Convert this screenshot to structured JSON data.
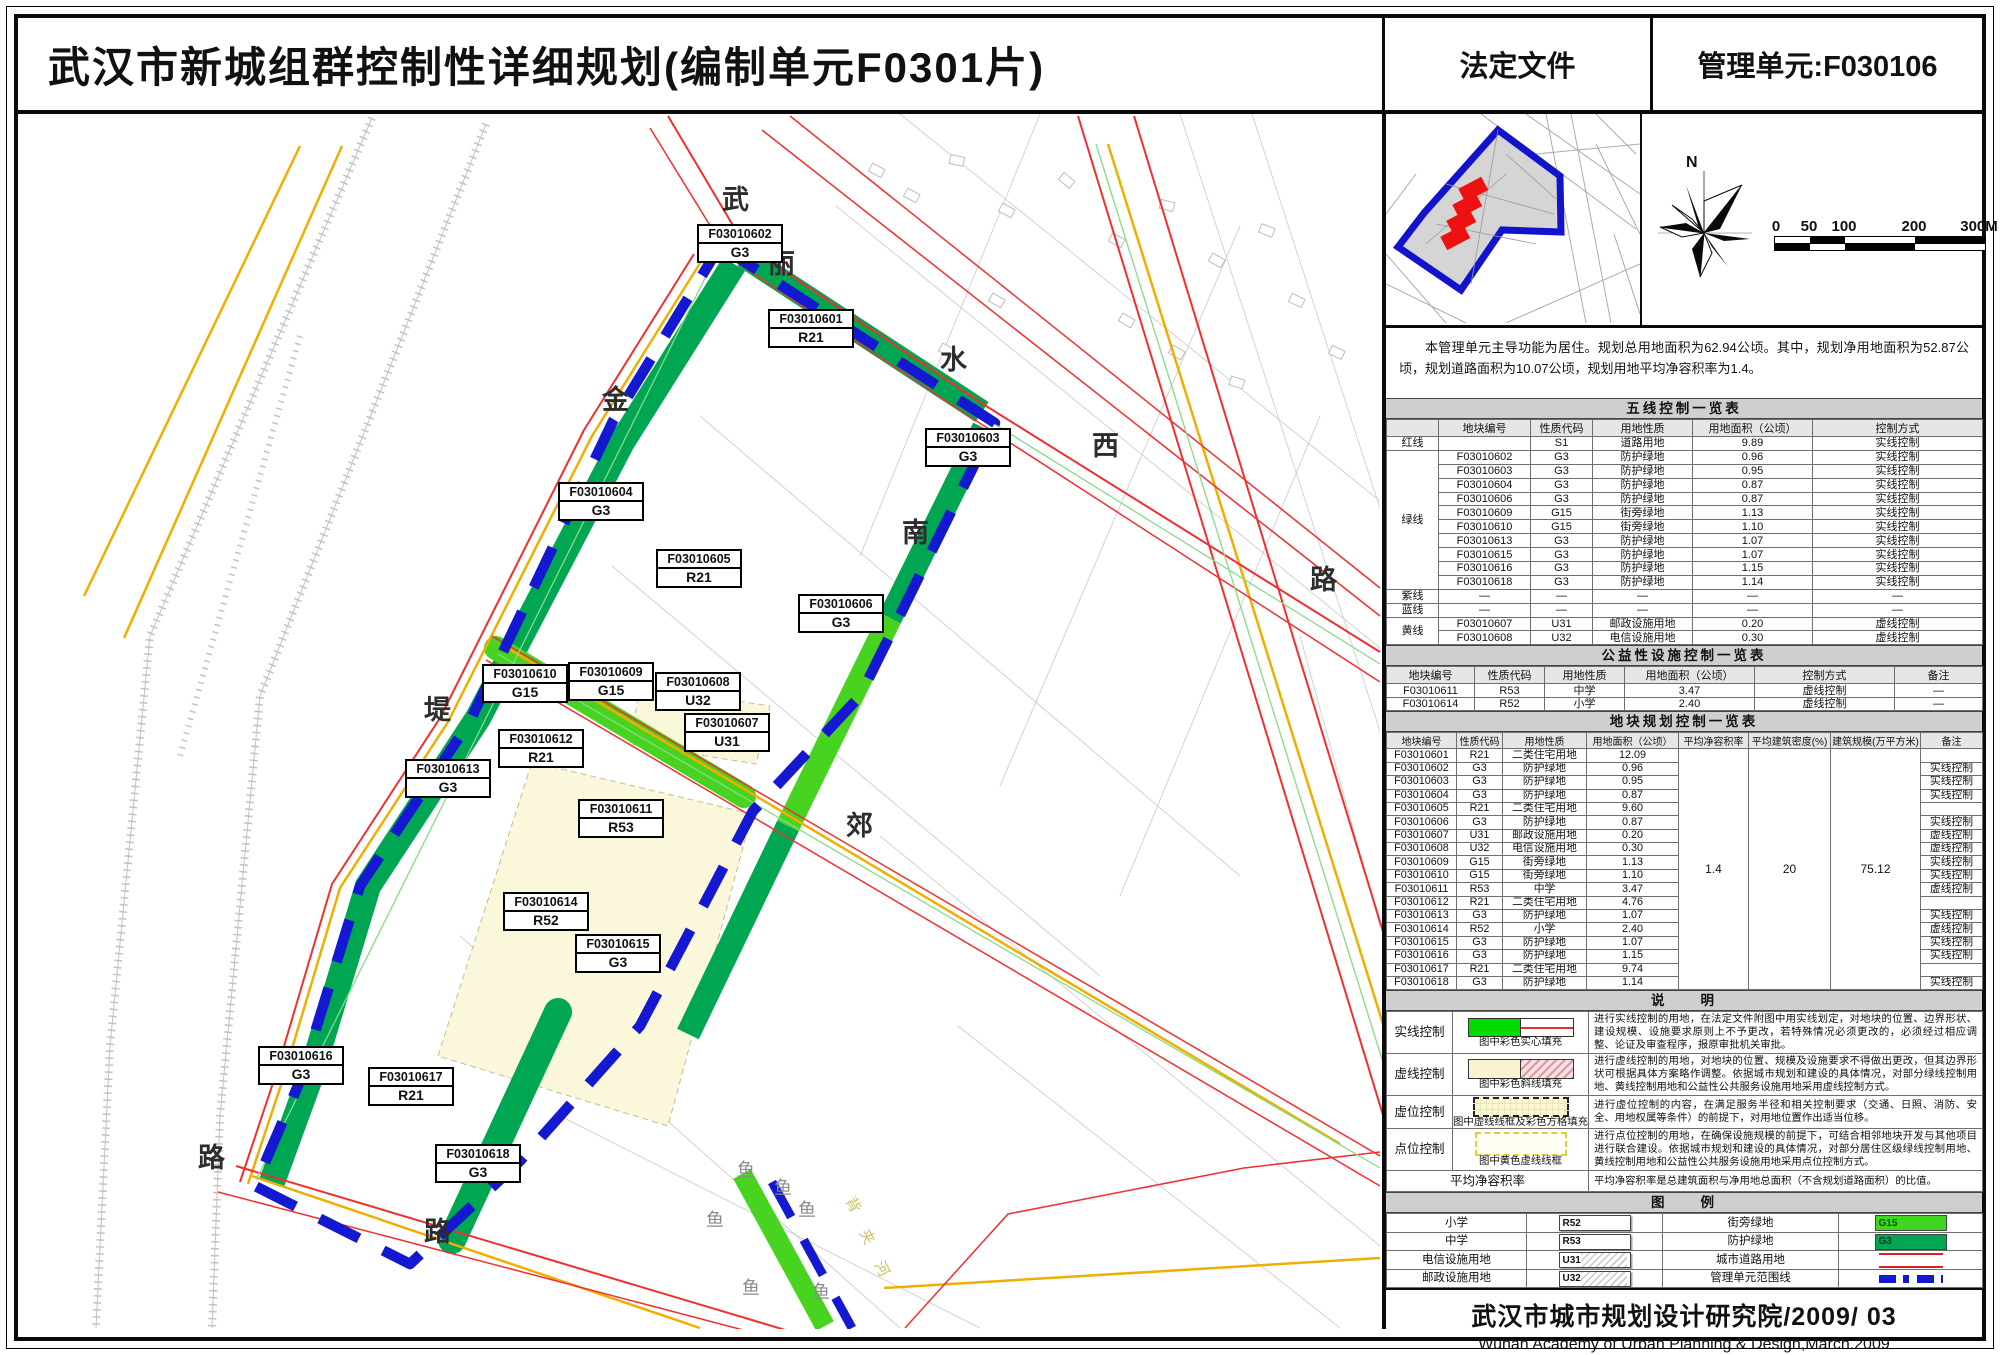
{
  "header": {
    "title": "武汉市新城组群控制性详细规划(编制单元F0301片)",
    "doc_type": "法定文件",
    "unit": "管理单元:F030106"
  },
  "compass": {
    "north": "N"
  },
  "scalebar": {
    "ticks": [
      "0",
      "50",
      "100",
      "200",
      "300M"
    ]
  },
  "intro": {
    "text": "本管理单元主导功能为居住。规划总用地面积为62.94公顷。其中，规划净用地面积为52.87公顷，规划道路面积为10.07公顷，规划用地平均净容积率为1.4。"
  },
  "five": {
    "title": "五线控制一览表",
    "headers": [
      "",
      "地块编号",
      "性质代码",
      "用地性质",
      "用地面积（公顷）",
      "控制方式"
    ],
    "rows": [
      {
        "cat": "红线",
        "span": 1,
        "code": "",
        "tcode": "S1",
        "use": "道路用地",
        "area": "9.89",
        "ctl": "实线控制"
      },
      {
        "cat": "绿线",
        "span": 10,
        "code": "F03010602",
        "tcode": "G3",
        "use": "防护绿地",
        "area": "0.96",
        "ctl": "实线控制"
      },
      {
        "code": "F03010603",
        "tcode": "G3",
        "use": "防护绿地",
        "area": "0.95",
        "ctl": "实线控制"
      },
      {
        "code": "F03010604",
        "tcode": "G3",
        "use": "防护绿地",
        "area": "0.87",
        "ctl": "实线控制"
      },
      {
        "code": "F03010606",
        "tcode": "G3",
        "use": "防护绿地",
        "area": "0.87",
        "ctl": "实线控制"
      },
      {
        "code": "F03010609",
        "tcode": "G15",
        "use": "街旁绿地",
        "area": "1.13",
        "ctl": "实线控制"
      },
      {
        "code": "F03010610",
        "tcode": "G15",
        "use": "街旁绿地",
        "area": "1.10",
        "ctl": "实线控制"
      },
      {
        "code": "F03010613",
        "tcode": "G3",
        "use": "防护绿地",
        "area": "1.07",
        "ctl": "实线控制"
      },
      {
        "code": "F03010615",
        "tcode": "G3",
        "use": "防护绿地",
        "area": "1.07",
        "ctl": "实线控制"
      },
      {
        "code": "F03010616",
        "tcode": "G3",
        "use": "防护绿地",
        "area": "1.15",
        "ctl": "实线控制"
      },
      {
        "code": "F03010618",
        "tcode": "G3",
        "use": "防护绿地",
        "area": "1.14",
        "ctl": "实线控制"
      },
      {
        "cat": "紫线",
        "span": 1,
        "code": "—",
        "tcode": "—",
        "use": "—",
        "area": "—",
        "ctl": "—"
      },
      {
        "cat": "蓝线",
        "span": 1,
        "code": "—",
        "tcode": "—",
        "use": "—",
        "area": "—",
        "ctl": "—"
      },
      {
        "cat": "黄线",
        "span": 2,
        "code": "F03010607",
        "tcode": "U31",
        "use": "邮政设施用地",
        "area": "0.20",
        "ctl": "虚线控制"
      },
      {
        "code": "F03010608",
        "tcode": "U32",
        "use": "电信设施用地",
        "area": "0.30",
        "ctl": "虚线控制"
      }
    ]
  },
  "pub": {
    "title": "公益性设施控制一览表",
    "headers": [
      "地块编号",
      "性质代码",
      "用地性质",
      "用地面积（公顷）",
      "控制方式",
      "备注"
    ],
    "rows": [
      {
        "code": "F03010611",
        "tcode": "R53",
        "use": "中学",
        "area": "3.47",
        "ctl": "虚线控制",
        "note": "—"
      },
      {
        "code": "F03010614",
        "tcode": "R52",
        "use": "小学",
        "area": "2.40",
        "ctl": "虚线控制",
        "note": "—"
      }
    ]
  },
  "parcel": {
    "title": "地块规划控制一览表",
    "headers": [
      "地块编号",
      "性质代码",
      "用地性质",
      "用地面积（公顷）",
      "平均净容积率",
      "平均建筑密度(%)",
      "建筑规模(万平方米)",
      "备注"
    ],
    "merged": {
      "far": "1.4",
      "density": "20",
      "scale": "75.12"
    },
    "rows": [
      {
        "code": "F03010601",
        "tcode": "R21",
        "use": "二类住宅用地",
        "area": "12.09",
        "note": ""
      },
      {
        "code": "F03010602",
        "tcode": "G3",
        "use": "防护绿地",
        "area": "0.96",
        "note": "实线控制"
      },
      {
        "code": "F03010603",
        "tcode": "G3",
        "use": "防护绿地",
        "area": "0.95",
        "note": "实线控制"
      },
      {
        "code": "F03010604",
        "tcode": "G3",
        "use": "防护绿地",
        "area": "0.87",
        "note": "实线控制"
      },
      {
        "code": "F03010605",
        "tcode": "R21",
        "use": "二类住宅用地",
        "area": "9.60",
        "note": ""
      },
      {
        "code": "F03010606",
        "tcode": "G3",
        "use": "防护绿地",
        "area": "0.87",
        "note": "实线控制"
      },
      {
        "code": "F03010607",
        "tcode": "U31",
        "use": "邮政设施用地",
        "area": "0.20",
        "note": "虚线控制"
      },
      {
        "code": "F03010608",
        "tcode": "U32",
        "use": "电信设施用地",
        "area": "0.30",
        "note": "虚线控制"
      },
      {
        "code": "F03010609",
        "tcode": "G15",
        "use": "街旁绿地",
        "area": "1.13",
        "note": "实线控制"
      },
      {
        "code": "F03010610",
        "tcode": "G15",
        "use": "街旁绿地",
        "area": "1.10",
        "note": "实线控制"
      },
      {
        "code": "F03010611",
        "tcode": "R53",
        "use": "中学",
        "area": "3.47",
        "note": "虚线控制"
      },
      {
        "code": "F03010612",
        "tcode": "R21",
        "use": "二类住宅用地",
        "area": "4.76",
        "note": ""
      },
      {
        "code": "F03010613",
        "tcode": "G3",
        "use": "防护绿地",
        "area": "1.07",
        "note": "实线控制"
      },
      {
        "code": "F03010614",
        "tcode": "R52",
        "use": "小学",
        "area": "2.40",
        "note": "虚线控制"
      },
      {
        "code": "F03010615",
        "tcode": "G3",
        "use": "防护绿地",
        "area": "1.07",
        "note": "实线控制"
      },
      {
        "code": "F03010616",
        "tcode": "G3",
        "use": "防护绿地",
        "area": "1.15",
        "note": "实线控制"
      },
      {
        "code": "F03010617",
        "tcode": "R21",
        "use": "二类住宅用地",
        "area": "9.74",
        "note": ""
      },
      {
        "code": "F03010618",
        "tcode": "G3",
        "use": "防护绿地",
        "area": "1.14",
        "note": "实线控制"
      }
    ]
  },
  "notes": {
    "title": "说　　明",
    "rows": [
      {
        "label": "实线控制",
        "swatch": "solid",
        "caption": "图中彩色实心填充",
        "text": "进行实线控制的用地，在法定文件附图中用实线划定，对地块的位置、边界形状、建设规模、设施要求原则上不予更改，若特殊情况必须更改的，必须经过相应调整、论证及审查程序，报原审批机关审批。"
      },
      {
        "label": "虚线控制",
        "swatch": "hatch",
        "caption": "图中彩色斜线填充",
        "text": "进行虚线控制的用地，对地块的位置、规模及设施要求不得做出更改，但其边界形状可根据具体方案略作调整。依据城市规划和建设的具体情况，对部分绿线控制用地、黄线控制用地和公益性公共服务设施用地采用虚线控制方式。"
      },
      {
        "label": "虚位控制",
        "swatch": "dash",
        "caption": "图中虚线线框及彩色方格填充",
        "text": "进行虚位控制的内容，在满足服务半径和相关控制要求（交通、日照、消防、安全、用地权属等条件）的前提下，对用地位置作出适当位移。"
      },
      {
        "label": "点位控制",
        "swatch": "ydash",
        "caption": "图中黄色虚线线框",
        "text": "进行点位控制的用地，在确保设施规模的前提下，可结合相邻地块开发与其他项目进行联合建设。依据城市规划和建设的具体情况，对部分居住区级绿线控制用地、黄线控制用地和公益性公共服务设施用地采用点位控制方式。"
      },
      {
        "label": "平均净容积率",
        "swatch": "none",
        "caption": "",
        "text": "平均净容积率是总建筑面积与净用地总面积（不含规划道路面积）的比值。"
      }
    ]
  },
  "legend": {
    "title": "图　　例",
    "rows": [
      {
        "left_label": "小学",
        "left_swatch": "R52",
        "right_label": "街旁绿地",
        "right_swatch": "G15"
      },
      {
        "left_label": "中学",
        "left_swatch": "R53",
        "right_label": "防护绿地",
        "right_swatch": "G3"
      },
      {
        "left_label": "电信设施用地",
        "left_swatch": "U31",
        "right_label": "城市道路用地",
        "right_swatch": "road"
      },
      {
        "left_label": "邮政设施用地",
        "left_swatch": "U32",
        "right_label": "管理单元范围线",
        "right_swatch": "boundary"
      }
    ]
  },
  "footer": {
    "cn": "武汉市城市规划设计研究院/2009/ 03",
    "en": "Wuhan Academy of Urban Planning & Design,March.2009"
  },
  "map": {
    "labels": [
      {
        "code": "F03010602",
        "type": "G3",
        "x": 697,
        "y": 228
      },
      {
        "code": "F03010601",
        "type": "R21",
        "x": 768,
        "y": 313
      },
      {
        "code": "F03010603",
        "type": "G3",
        "x": 925,
        "y": 432
      },
      {
        "code": "F03010604",
        "type": "G3",
        "x": 558,
        "y": 486
      },
      {
        "code": "F03010605",
        "type": "R21",
        "x": 656,
        "y": 553
      },
      {
        "code": "F03010606",
        "type": "G3",
        "x": 798,
        "y": 598
      },
      {
        "code": "F03010610",
        "type": "G15",
        "x": 482,
        "y": 668
      },
      {
        "code": "F03010609",
        "type": "G15",
        "x": 568,
        "y": 666
      },
      {
        "code": "F03010608",
        "type": "U32",
        "x": 655,
        "y": 676
      },
      {
        "code": "F03010607",
        "type": "U31",
        "x": 684,
        "y": 717
      },
      {
        "code": "F03010612",
        "type": "R21",
        "x": 498,
        "y": 733
      },
      {
        "code": "F03010613",
        "type": "G3",
        "x": 405,
        "y": 763
      },
      {
        "code": "F03010611",
        "type": "R53",
        "x": 578,
        "y": 803
      },
      {
        "code": "F03010614",
        "type": "R52",
        "x": 503,
        "y": 896
      },
      {
        "code": "F03010615",
        "type": "G3",
        "x": 575,
        "y": 938
      },
      {
        "code": "F03010616",
        "type": "G3",
        "x": 258,
        "y": 1050
      },
      {
        "code": "F03010617",
        "type": "R21",
        "x": 368,
        "y": 1071
      },
      {
        "code": "F03010618",
        "type": "G3",
        "x": 435,
        "y": 1148
      }
    ],
    "road_chars": [
      {
        "ch": "武",
        "x": 722,
        "y": 182,
        "cls": "road"
      },
      {
        "ch": "丽",
        "x": 768,
        "y": 246,
        "cls": "road"
      },
      {
        "ch": "金",
        "x": 602,
        "y": 382,
        "cls": "road"
      },
      {
        "ch": "水",
        "x": 940,
        "y": 342,
        "cls": "road"
      },
      {
        "ch": "西",
        "x": 1092,
        "y": 428,
        "cls": "road"
      },
      {
        "ch": "南",
        "x": 902,
        "y": 515,
        "cls": "road"
      },
      {
        "ch": "路",
        "x": 1310,
        "y": 562,
        "cls": "road"
      },
      {
        "ch": "堤",
        "x": 424,
        "y": 692,
        "cls": "road"
      },
      {
        "ch": "郊",
        "x": 846,
        "y": 808,
        "cls": "road"
      },
      {
        "ch": "路",
        "x": 198,
        "y": 1140,
        "cls": "road"
      },
      {
        "ch": "路",
        "x": 424,
        "y": 1214,
        "cls": "road"
      },
      {
        "ch": "鱼",
        "x": 737,
        "y": 1160,
        "cls": "fish"
      },
      {
        "ch": "鱼",
        "x": 774,
        "y": 1178,
        "cls": "fish"
      },
      {
        "ch": "鱼",
        "x": 798,
        "y": 1200,
        "cls": "fish"
      },
      {
        "ch": "鱼",
        "x": 706,
        "y": 1210,
        "cls": "fish"
      },
      {
        "ch": "鱼",
        "x": 742,
        "y": 1278,
        "cls": "fish"
      },
      {
        "ch": "鱼",
        "x": 812,
        "y": 1282,
        "cls": "fish"
      },
      {
        "ch": "背",
        "x": 846,
        "y": 1198,
        "cls": "faint"
      },
      {
        "ch": "夹",
        "x": 860,
        "y": 1230,
        "cls": "faint"
      },
      {
        "ch": "河",
        "x": 875,
        "y": 1262,
        "cls": "faint"
      }
    ]
  },
  "colors": {
    "protective_green": "#00a651",
    "street_green": "#47d31f",
    "boundary_blue": "#1418d0",
    "road_red": "#f03030",
    "road_yellow": "#efae00",
    "dashed_parcel_cream": "#faf7d8",
    "inset_fill": "#d5d5d5",
    "inset_highlight_red": "#ee1111"
  }
}
